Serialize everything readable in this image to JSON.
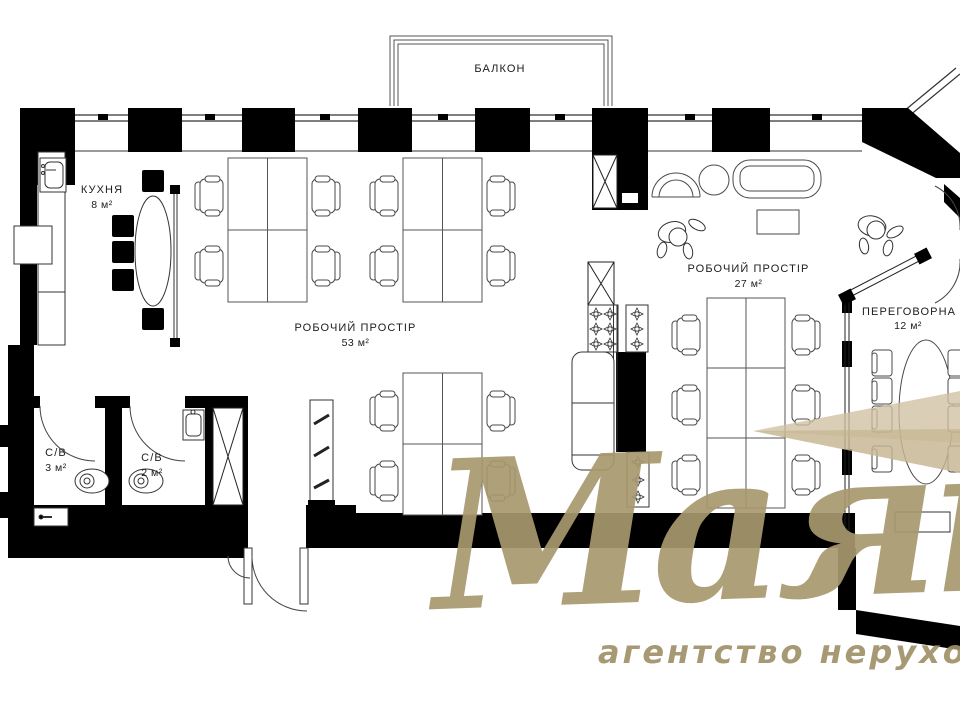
{
  "plan": {
    "balcony": {
      "label": "БАЛКОН"
    },
    "rooms": [
      {
        "id": "kitchen",
        "name": "КУХНЯ",
        "area": "8 м²"
      },
      {
        "id": "workspace-main",
        "name": "РОБОЧИЙ ПРОСТІР",
        "area": "53 м²"
      },
      {
        "id": "workspace-second",
        "name": "РОБОЧИЙ ПРОСТІР",
        "area": "27 м²"
      },
      {
        "id": "meeting-room",
        "name": "ПЕРЕГОВОРНА КІМНАТА",
        "area": "12 м²"
      },
      {
        "id": "wc-1",
        "name": "С/В",
        "area": "3 м²"
      },
      {
        "id": "wc-2",
        "name": "С/В",
        "area": "2 м²"
      }
    ]
  },
  "watermark": {
    "brand": "Маяк",
    "tagline": "агентство нерухомості",
    "gold": "#a8986e",
    "beam": "#cec0a0"
  },
  "colors": {
    "wall": "#000000",
    "line": "#444444",
    "background": "#ffffff"
  }
}
